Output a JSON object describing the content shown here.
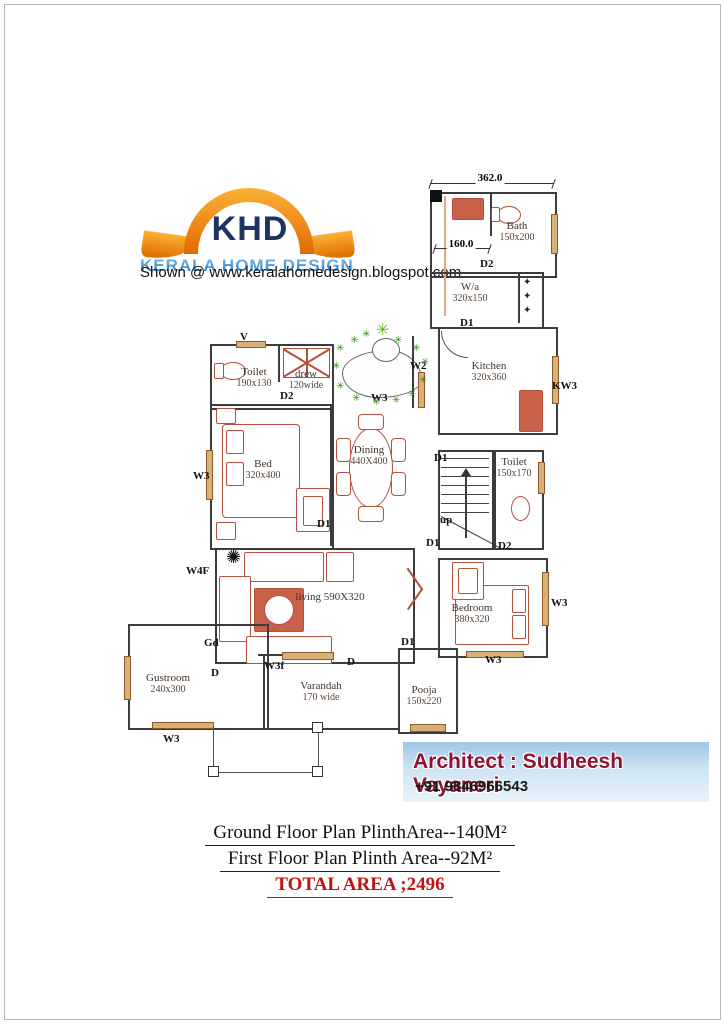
{
  "logo": {
    "khd": "KHD",
    "subtitle": "KERALA HOME DESIGN",
    "shown_line": "Shown @  www.keralahomedesign.blogspot.com"
  },
  "plan": {
    "top_dimension": "362.0",
    "lobby_dimension": "160.0",
    "rooms": [
      {
        "name": "Bath",
        "dims": "150x200",
        "x": 517,
        "y": 220
      },
      {
        "name": "W/a",
        "dims": "320x150",
        "x": 470,
        "y": 281
      },
      {
        "name": "Kitchen",
        "dims": "320x360",
        "x": 489,
        "y": 360
      },
      {
        "name": "Toilet",
        "dims": "150x170",
        "x": 514,
        "y": 456
      },
      {
        "name": "Toilet",
        "dims": "190x130",
        "x": 254,
        "y": 366
      },
      {
        "name": "drew",
        "dims": "120wide",
        "x": 306,
        "y": 368
      },
      {
        "name": "Bed",
        "dims": "320x400",
        "x": 263,
        "y": 458
      },
      {
        "name": "Dining",
        "dims": "440X400",
        "x": 369,
        "y": 444
      },
      {
        "name": "living  590X320",
        "dims": "",
        "x": 330,
        "y": 591
      },
      {
        "name": "Bedroom",
        "dims": "380x320",
        "x": 472,
        "y": 602
      },
      {
        "name": "Gustroom",
        "dims": "240x300",
        "x": 168,
        "y": 672
      },
      {
        "name": "Varandah",
        "dims": "170 wide",
        "x": 321,
        "y": 680
      },
      {
        "name": "Pooja",
        "dims": "150x220",
        "x": 424,
        "y": 684
      }
    ],
    "tags": [
      {
        "t": "D2",
        "x": 480,
        "y": 258
      },
      {
        "t": "D1",
        "x": 460,
        "y": 317
      },
      {
        "t": "KW3",
        "x": 552,
        "y": 380
      },
      {
        "t": "D1",
        "x": 434,
        "y": 452
      },
      {
        "t": "up",
        "x": 440,
        "y": 514
      },
      {
        "t": "D1",
        "x": 426,
        "y": 537
      },
      {
        "t": "D2",
        "x": 498,
        "y": 540
      },
      {
        "t": "V",
        "x": 240,
        "y": 331
      },
      {
        "t": "D2",
        "x": 280,
        "y": 390
      },
      {
        "t": "W3",
        "x": 371,
        "y": 392
      },
      {
        "t": "W2",
        "x": 410,
        "y": 360
      },
      {
        "t": "W3",
        "x": 193,
        "y": 470
      },
      {
        "t": "D1",
        "x": 317,
        "y": 518
      },
      {
        "t": "W4F",
        "x": 186,
        "y": 565
      },
      {
        "t": "Gd",
        "x": 204,
        "y": 637
      },
      {
        "t": "D",
        "x": 211,
        "y": 667
      },
      {
        "t": "W3f",
        "x": 264,
        "y": 660
      },
      {
        "t": "W3",
        "x": 163,
        "y": 733
      },
      {
        "t": "D",
        "x": 347,
        "y": 656
      },
      {
        "t": "D1",
        "x": 401,
        "y": 636
      },
      {
        "t": "W3",
        "x": 485,
        "y": 654
      },
      {
        "t": "W3",
        "x": 551,
        "y": 597
      }
    ],
    "plants": {
      "glyph": "✳",
      "black_glyph": "✺",
      "positions": [
        {
          "x": 336,
          "y": 344
        },
        {
          "x": 350,
          "y": 336
        },
        {
          "x": 362,
          "y": 330
        },
        {
          "x": 394,
          "y": 336
        },
        {
          "x": 412,
          "y": 344
        },
        {
          "x": 421,
          "y": 358
        },
        {
          "x": 419,
          "y": 376
        },
        {
          "x": 408,
          "y": 390
        },
        {
          "x": 392,
          "y": 396
        },
        {
          "x": 372,
          "y": 398
        },
        {
          "x": 352,
          "y": 394
        },
        {
          "x": 336,
          "y": 382
        },
        {
          "x": 332,
          "y": 362
        },
        {
          "x": 376,
          "y": 326
        }
      ]
    }
  },
  "architect": {
    "title": "Architect : Sudheesh Vayaneri",
    "phone": "+91  9846966543",
    "accent_color": "#8e1330",
    "banner_color": "#aecfe8"
  },
  "footer": {
    "line1": "Ground Floor Plan  PlinthArea--140M²",
    "line2": "First Floor Plan  Plinth Area--92M²",
    "total": "TOTAL AREA ;2496"
  }
}
